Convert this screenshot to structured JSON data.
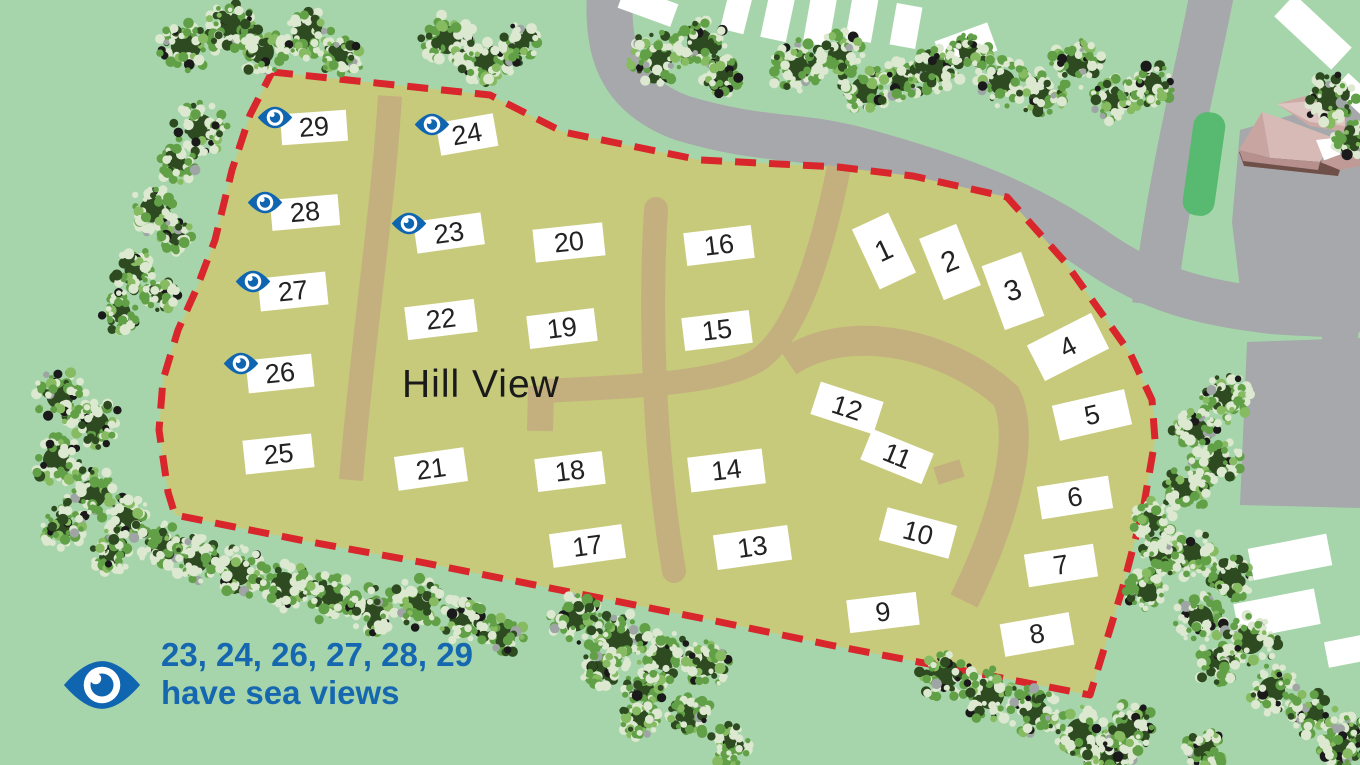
{
  "area_label": "Hill View",
  "legend": {
    "plots_with_view": "23, 24, 26, 27, 28, 29",
    "caption": "have sea views",
    "icon": "eye-icon"
  },
  "sea_view_plots": [
    "23",
    "24",
    "26",
    "27",
    "28",
    "29"
  ],
  "colors": {
    "background": "#a7d5ab",
    "site_fill": "#c7ca7b",
    "path_tan": "#c3b07e",
    "road_gray": "#a6a8ab",
    "boundary_red": "#d8262c",
    "eye_blue": "#1065b0",
    "legend_text_blue": "#1568b0",
    "plot_text": "#222222",
    "verge_green": "#58ba70",
    "roof_pink": "#d7b9b5",
    "tree_dark": "#2d4a20",
    "tree_mid": "#61a046",
    "tree_light": "#dce8d0"
  },
  "map": {
    "width": 1360,
    "height": 765,
    "boundary_points": "272,72 490,95 563,132 700,160 838,167 913,176 1007,197 1065,262 1130,353 1152,400 1155,440 1143,510 1122,590 1090,695 950,668 830,645 720,622 560,590 420,562 300,540 175,515 168,492 159,430 163,380 178,330 196,290 215,240 232,170 250,115",
    "layers": [
      {
        "name": "roads",
        "shapes": [
          {
            "t": "path",
            "d": "M612,-30 C604,40 612,92 682,118 C762,142 798,134 858,150 C962,178 1032,206 1097,252 C1152,290 1202,303 1272,311 C1305,314 1335,313 1361,317",
            "sw": 46,
            "s": "#a6a8ab"
          },
          {
            "t": "path",
            "d": "M1213,-12 C1200,60 1172,160 1154,305",
            "sw": 44,
            "s": "#a6a8ab"
          },
          {
            "t": "poly",
            "p": "1240,130 1360,95 1360,332 1245,330 1232,222",
            "f": "#a6a8ab"
          },
          {
            "t": "poly",
            "p": "1247,342 1360,338 1360,508 1240,505",
            "f": "#a6a8ab"
          },
          {
            "t": "poly",
            "p": "1322,328 1356,328 1356,346 1322,346",
            "f": "#a6a8ab"
          },
          {
            "t": "poly",
            "p": "823,130 854,133 851,172 825,170",
            "f": "#a6a8ab"
          }
        ]
      },
      {
        "name": "verge",
        "shapes": [
          {
            "t": "rect",
            "x": 1188,
            "y": 112,
            "w": 32,
            "h": 104,
            "rx": 14,
            "rot": 8,
            "f": "#58ba70"
          }
        ]
      },
      {
        "name": "building",
        "shapes": [
          {
            "t": "poly",
            "p": "1239,152 1320,160 1340,170 1338,176 1244,166",
            "f": "#6f5049"
          },
          {
            "t": "poly",
            "p": "1277,104 1305,96 1345,110 1345,132 1310,126",
            "f": "#cdaaa6"
          },
          {
            "t": "poly",
            "p": "1277,104 1311,101 1345,116 1345,126 1310,122",
            "f": "#dec5c1"
          },
          {
            "t": "poly",
            "p": "1239,150 1262,112 1286,120 1270,158",
            "f": "#c8a5a1"
          },
          {
            "t": "poly",
            "p": "1262,112 1286,120 1334,138 1320,162 1270,158",
            "f": "#d7b9b5"
          },
          {
            "t": "poly",
            "p": "1239,150 1270,158 1320,162 1318,170 1243,161",
            "f": "#b5908c"
          },
          {
            "t": "poly",
            "p": "1316,140 1334,138 1342,158 1324,160",
            "f": "#ffffff"
          },
          {
            "t": "poly",
            "p": "1320,162 1352,150 1360,155 1360,166 1340,170",
            "f": "#c09a96"
          }
        ]
      },
      {
        "name": "site-area",
        "shapes": [
          {
            "t": "site"
          }
        ]
      },
      {
        "name": "site-paths",
        "shapes": [
          {
            "t": "path",
            "d": "M390,96 C383,210 362,345 351,480",
            "sw": 24,
            "s": "#c3b07e"
          },
          {
            "t": "path",
            "d": "M656,209 C649,320 655,460 674,571",
            "sw": 24,
            "s": "#c3b07e",
            "cap": "round"
          },
          {
            "t": "path",
            "d": "M545,391 C640,386 722,383 758,360 C801,331 825,236 839,167",
            "sw": 24,
            "s": "#c3b07e"
          },
          {
            "t": "path",
            "d": "M541,386 L540,431",
            "sw": 26,
            "s": "#c3b07e"
          },
          {
            "t": "path",
            "d": "M788,362 C850,320 950,345 1006,396 C1028,440 1000,528 964,601",
            "sw": 30,
            "s": "#c3b07e"
          },
          {
            "t": "path",
            "d": "M962,468 L936,476",
            "sw": 18,
            "s": "#c3b07e"
          }
        ]
      },
      {
        "name": "caravans",
        "shapes": [
          {
            "t": "rect",
            "x": 620,
            "y": -6,
            "w": 56,
            "h": 24,
            "rot": 20,
            "f": "#ffffff"
          },
          {
            "t": "rect",
            "x": 725,
            "y": -12,
            "w": 24,
            "h": 44,
            "rot": 14,
            "f": "#ffffff"
          },
          {
            "t": "rect",
            "x": 765,
            "y": -8,
            "w": 26,
            "h": 48,
            "rot": 12,
            "f": "#ffffff"
          },
          {
            "t": "rect",
            "x": 807,
            "y": -5,
            "w": 26,
            "h": 50,
            "rot": 10,
            "f": "#ffffff"
          },
          {
            "t": "rect",
            "x": 849,
            "y": -5,
            "w": 26,
            "h": 46,
            "rot": 10,
            "f": "#ffffff"
          },
          {
            "t": "rect",
            "x": 893,
            "y": 5,
            "w": 26,
            "h": 42,
            "rot": 10,
            "f": "#ffffff"
          },
          {
            "t": "rect",
            "x": 938,
            "y": 31,
            "w": 56,
            "h": 30,
            "rot": -20,
            "f": "#ffffff"
          },
          {
            "t": "rect",
            "x": 1274,
            "y": 17,
            "w": 78,
            "h": 30,
            "rot": 43,
            "f": "#ffffff"
          },
          {
            "t": "rect",
            "x": 1335,
            "y": 85,
            "w": 44,
            "h": 22,
            "rot": 43,
            "f": "#ffffff"
          },
          {
            "t": "rect",
            "x": 1250,
            "y": 541,
            "w": 80,
            "h": 32,
            "rot": -11,
            "f": "#ffffff"
          },
          {
            "t": "rect",
            "x": 1236,
            "y": 596,
            "w": 82,
            "h": 36,
            "rot": -11,
            "f": "#ffffff"
          },
          {
            "t": "rect",
            "x": 1326,
            "y": 637,
            "w": 52,
            "h": 26,
            "rot": -11,
            "f": "#ffffff"
          }
        ]
      },
      {
        "name": "boundary-line",
        "shapes": [
          {
            "t": "boundary"
          }
        ]
      }
    ],
    "trees": [
      [
        186,
        46,
        29
      ],
      [
        232,
        26,
        24
      ],
      [
        262,
        52,
        23
      ],
      [
        306,
        34,
        26
      ],
      [
        342,
        56,
        21
      ],
      [
        447,
        40,
        27
      ],
      [
        487,
        62,
        25
      ],
      [
        519,
        44,
        20
      ],
      [
        658,
        58,
        28
      ],
      [
        700,
        42,
        25
      ],
      [
        722,
        74,
        21
      ],
      [
        797,
        66,
        28
      ],
      [
        840,
        54,
        23
      ],
      [
        864,
        90,
        25
      ],
      [
        902,
        80,
        21
      ],
      [
        938,
        70,
        23
      ],
      [
        970,
        52,
        21
      ],
      [
        1002,
        82,
        25
      ],
      [
        1042,
        94,
        23
      ],
      [
        1077,
        64,
        25
      ],
      [
        1114,
        100,
        23
      ],
      [
        1150,
        84,
        23
      ],
      [
        1330,
        98,
        26
      ],
      [
        1352,
        140,
        18
      ],
      [
        200,
        128,
        27
      ],
      [
        176,
        164,
        20
      ],
      [
        152,
        210,
        24
      ],
      [
        176,
        236,
        17
      ],
      [
        136,
        270,
        22
      ],
      [
        160,
        294,
        17
      ],
      [
        120,
        312,
        20
      ],
      [
        60,
        396,
        26
      ],
      [
        96,
        424,
        25
      ],
      [
        56,
        460,
        25
      ],
      [
        92,
        494,
        27
      ],
      [
        62,
        528,
        21
      ],
      [
        126,
        520,
        25
      ],
      [
        110,
        556,
        19
      ],
      [
        162,
        546,
        23
      ],
      [
        196,
        560,
        24
      ],
      [
        238,
        572,
        26
      ],
      [
        284,
        585,
        25
      ],
      [
        330,
        598,
        25
      ],
      [
        374,
        610,
        24
      ],
      [
        418,
        602,
        26
      ],
      [
        462,
        620,
        24
      ],
      [
        502,
        634,
        21
      ],
      [
        575,
        618,
        26
      ],
      [
        618,
        640,
        29
      ],
      [
        664,
        656,
        27
      ],
      [
        706,
        664,
        23
      ],
      [
        600,
        670,
        19
      ],
      [
        644,
        690,
        20
      ],
      [
        690,
        715,
        22
      ],
      [
        640,
        720,
        20
      ],
      [
        730,
        745,
        21
      ],
      [
        945,
        675,
        26
      ],
      [
        990,
        695,
        27
      ],
      [
        1035,
        712,
        25
      ],
      [
        1080,
        732,
        26
      ],
      [
        1115,
        753,
        22
      ],
      [
        1190,
        554,
        25
      ],
      [
        1160,
        556,
        21
      ],
      [
        1146,
        590,
        20
      ],
      [
        1230,
        578,
        23
      ],
      [
        1200,
        618,
        25
      ],
      [
        1250,
        640,
        27
      ],
      [
        1216,
        664,
        21
      ],
      [
        1272,
        690,
        25
      ],
      [
        1312,
        714,
        23
      ],
      [
        1350,
        734,
        21
      ],
      [
        1130,
        728,
        25
      ],
      [
        1102,
        756,
        18
      ],
      [
        1205,
        748,
        21
      ],
      [
        1340,
        748,
        22
      ],
      [
        1226,
        398,
        25
      ],
      [
        1196,
        430,
        23
      ],
      [
        1216,
        460,
        25
      ],
      [
        1186,
        490,
        23
      ],
      [
        1152,
        520,
        21
      ]
    ],
    "plots": [
      {
        "n": "1",
        "x": 884,
        "y": 251,
        "w": 40,
        "h": 66,
        "rot": -25
      },
      {
        "n": "2",
        "x": 950,
        "y": 262,
        "w": 40,
        "h": 66,
        "rot": -22
      },
      {
        "n": "3",
        "x": 1013,
        "y": 291,
        "w": 42,
        "h": 68,
        "rot": -20
      },
      {
        "n": "4",
        "x": 1068,
        "y": 347,
        "w": 72,
        "h": 40,
        "rot": -27
      },
      {
        "n": "5",
        "x": 1092,
        "y": 415,
        "w": 74,
        "h": 36,
        "rot": -13
      },
      {
        "n": "6",
        "x": 1075,
        "y": 497,
        "w": 72,
        "h": 33,
        "rot": -9
      },
      {
        "n": "7",
        "x": 1061,
        "y": 565,
        "w": 70,
        "h": 33,
        "rot": -9
      },
      {
        "n": "8",
        "x": 1037,
        "y": 634,
        "w": 70,
        "h": 33,
        "rot": -10
      },
      {
        "n": "9",
        "x": 883,
        "y": 612,
        "w": 70,
        "h": 33,
        "rot": -7
      },
      {
        "n": "10",
        "x": 918,
        "y": 533,
        "w": 72,
        "h": 34,
        "rot": 15
      },
      {
        "n": "11",
        "x": 897,
        "y": 456,
        "w": 66,
        "h": 33,
        "rot": 22
      },
      {
        "n": "12",
        "x": 847,
        "y": 408,
        "w": 66,
        "h": 34,
        "rot": 18
      },
      {
        "n": "13",
        "x": 752,
        "y": 547,
        "w": 75,
        "h": 35,
        "rot": -8
      },
      {
        "n": "14",
        "x": 726,
        "y": 470,
        "w": 75,
        "h": 35,
        "rot": -7
      },
      {
        "n": "15",
        "x": 717,
        "y": 330,
        "w": 68,
        "h": 33,
        "rot": -7
      },
      {
        "n": "16",
        "x": 719,
        "y": 245,
        "w": 68,
        "h": 33,
        "rot": -7
      },
      {
        "n": "17",
        "x": 587,
        "y": 546,
        "w": 73,
        "h": 34,
        "rot": -8
      },
      {
        "n": "18",
        "x": 570,
        "y": 471,
        "w": 68,
        "h": 33,
        "rot": -7
      },
      {
        "n": "19",
        "x": 562,
        "y": 328,
        "w": 68,
        "h": 33,
        "rot": -7
      },
      {
        "n": "20",
        "x": 569,
        "y": 242,
        "w": 70,
        "h": 33,
        "rot": -6
      },
      {
        "n": "21",
        "x": 431,
        "y": 469,
        "w": 70,
        "h": 34,
        "rot": -8
      },
      {
        "n": "22",
        "x": 441,
        "y": 319,
        "w": 70,
        "h": 33,
        "rot": -7
      },
      {
        "n": "23",
        "x": 449,
        "y": 233,
        "w": 68,
        "h": 32,
        "rot": -8,
        "eye": true
      },
      {
        "n": "24",
        "x": 467,
        "y": 134,
        "w": 58,
        "h": 33,
        "rot": -10,
        "eye": true
      },
      {
        "n": "25",
        "x": 278,
        "y": 454,
        "w": 69,
        "h": 34,
        "rot": -6
      },
      {
        "n": "26",
        "x": 280,
        "y": 373,
        "w": 66,
        "h": 33,
        "rot": -6,
        "eye": true
      },
      {
        "n": "27",
        "x": 293,
        "y": 291,
        "w": 68,
        "h": 33,
        "rot": -6,
        "eye": true
      },
      {
        "n": "28",
        "x": 305,
        "y": 212,
        "w": 68,
        "h": 31,
        "rot": -5,
        "eye": true
      },
      {
        "n": "29",
        "x": 314,
        "y": 127,
        "w": 66,
        "h": 31,
        "rot": -4,
        "eye": true
      }
    ]
  }
}
